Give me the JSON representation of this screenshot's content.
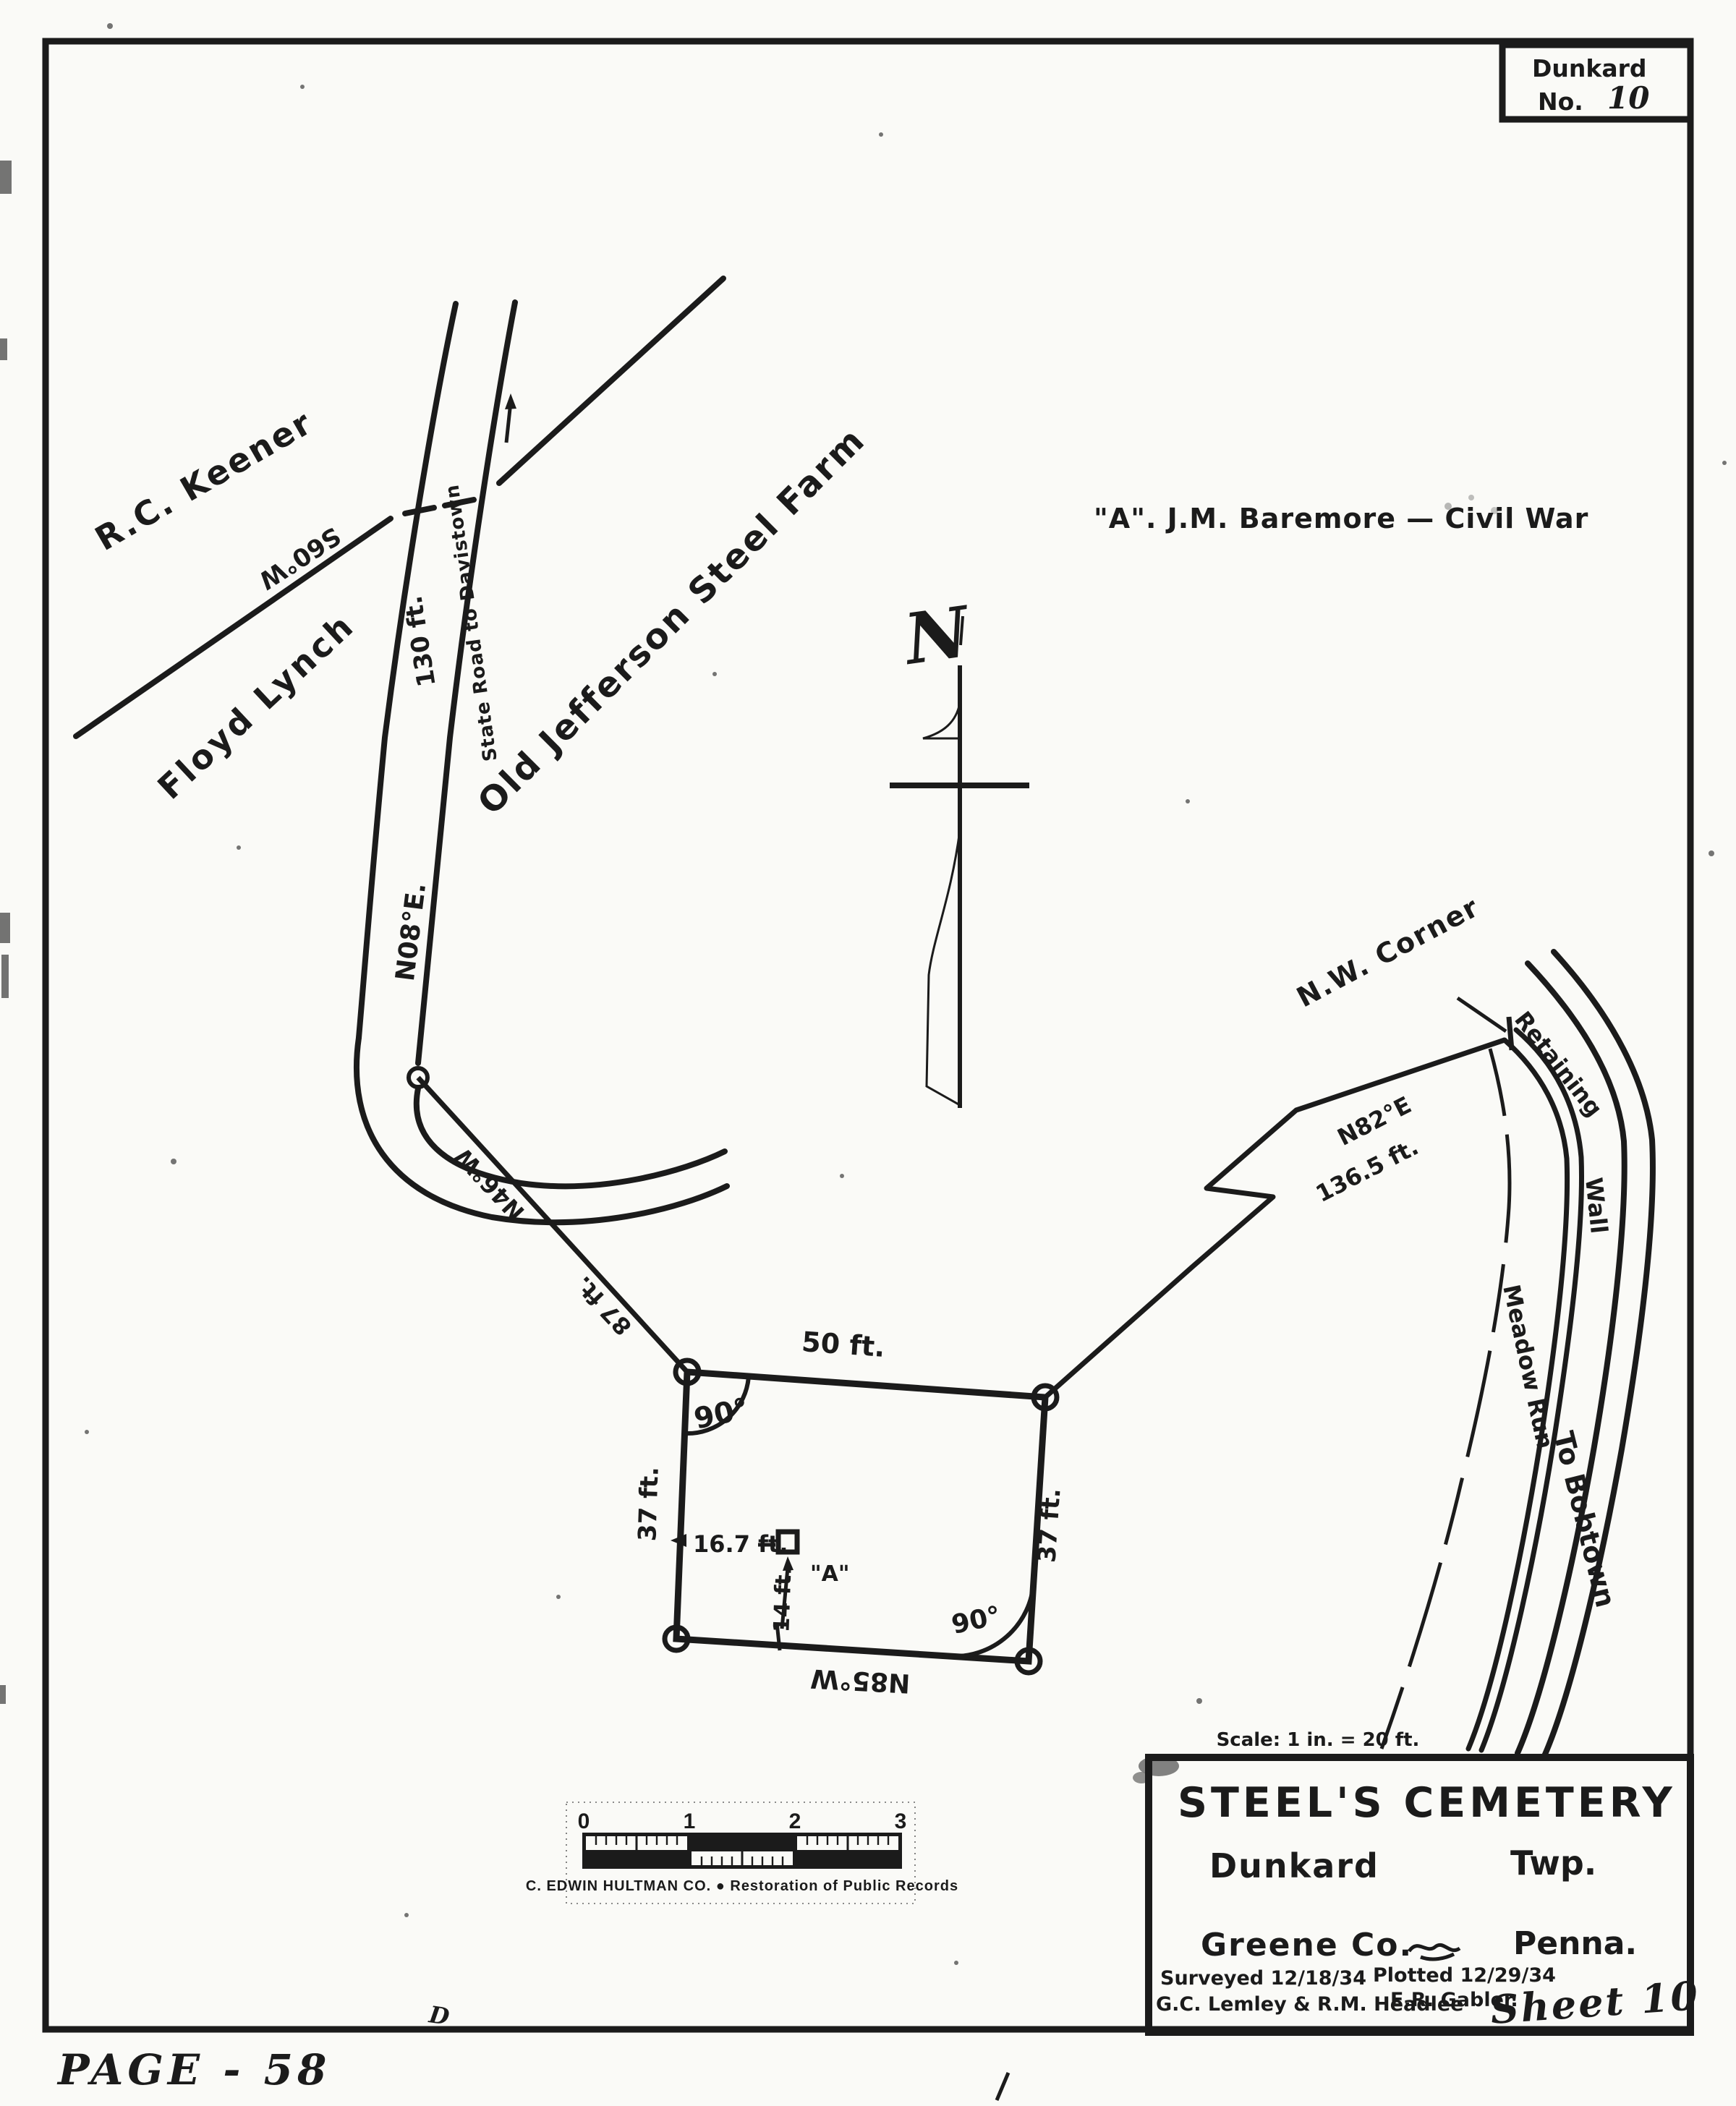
{
  "colors": {
    "ink": "#1b1b1b",
    "paper": "#fafaf7"
  },
  "corner_box": {
    "township": "Dunkard",
    "no_label": "No.",
    "no_value": "10"
  },
  "map": {
    "landowner_keener": "R.C. Keener",
    "keener_line_bearing": "S60°W",
    "landowner_lynch": "Floyd Lynch",
    "farm_label": "Old Jefferson Steel Farm",
    "grave_note": "\"A\". J.M. Baremore — Civil War",
    "north_letter": "N",
    "state_road": "State Road to Davistown",
    "state_road_distance": "130 ft.",
    "state_road_bearing": "N08°E.",
    "west_tie_bearing": "N46°W",
    "west_tie_distance": "87 ft.",
    "east_tie_bearing": "N82°E",
    "east_tie_distance": "136.5 ft.",
    "nw_corner_note": "N.W. Corner",
    "retaining_word": "Retaining",
    "wall_word": "Wall",
    "stream_label": "Meadow Run",
    "to_bobtown": "To Bobtown",
    "cemetery": {
      "north_side": "50 ft.",
      "west_side": "37 ft.",
      "east_side": "37 ft.",
      "south_bearing": "N85°W",
      "nw_angle": "90°",
      "se_angle": "90°",
      "grave_offset_west": "16.7 ft.",
      "grave_offset_south": "14 ft.",
      "grave_id": "\"A\""
    }
  },
  "scalebar": {
    "n0": "0",
    "n1": "1",
    "n2": "2",
    "n3": "3",
    "caption": "C. EDWIN HULTMAN CO.  ●  Restoration of Public Records"
  },
  "title_block": {
    "scale_note": "Scale: 1 in. = 20 ft.",
    "title": "STEEL'S CEMETERY",
    "township": "Dunkard",
    "township_suffix": "Twp.",
    "county": "Greene Co.",
    "state": "Penna.",
    "surveyed_line1": "Surveyed 12/18/34",
    "surveyed_line2": "G.C. Lemley & R.M. Headlee",
    "plotted_line1": "Plotted 12/29/34",
    "plotted_line2": "E.R. Gabler."
  },
  "footer": {
    "page_number": "PAGE - 58",
    "small_mark": "D",
    "sheet": "Sheet 10"
  }
}
